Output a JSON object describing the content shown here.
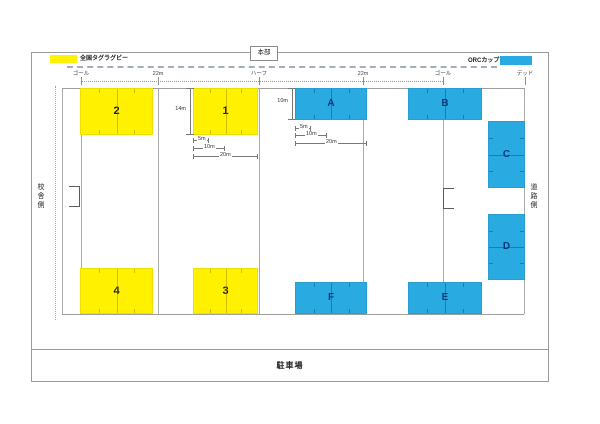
{
  "legend": {
    "tag_rugby_label": "全国タグラグビー",
    "orc_cup_label": "ORCカップ",
    "yellow_color": "#fff100",
    "blue_color": "#29abe2"
  },
  "hq_label": "本部",
  "marks": [
    "ゴール",
    "22m",
    "ハーフ",
    "22m",
    "ゴール",
    "デッド"
  ],
  "sides": {
    "left": "校舎側",
    "right": "道路側"
  },
  "parking_label": "駐車場",
  "courts": {
    "yellow": [
      "2",
      "1",
      "4",
      "3"
    ],
    "blue": [
      "A",
      "B",
      "C",
      "D",
      "F",
      "E"
    ]
  },
  "dims": {
    "court1": {
      "height": "14m",
      "d5": "5m",
      "d10": "10m",
      "d20": "20m"
    },
    "courtA": {
      "height": "10m",
      "d5": "5m",
      "d10": "10m",
      "d20": "20m"
    }
  }
}
